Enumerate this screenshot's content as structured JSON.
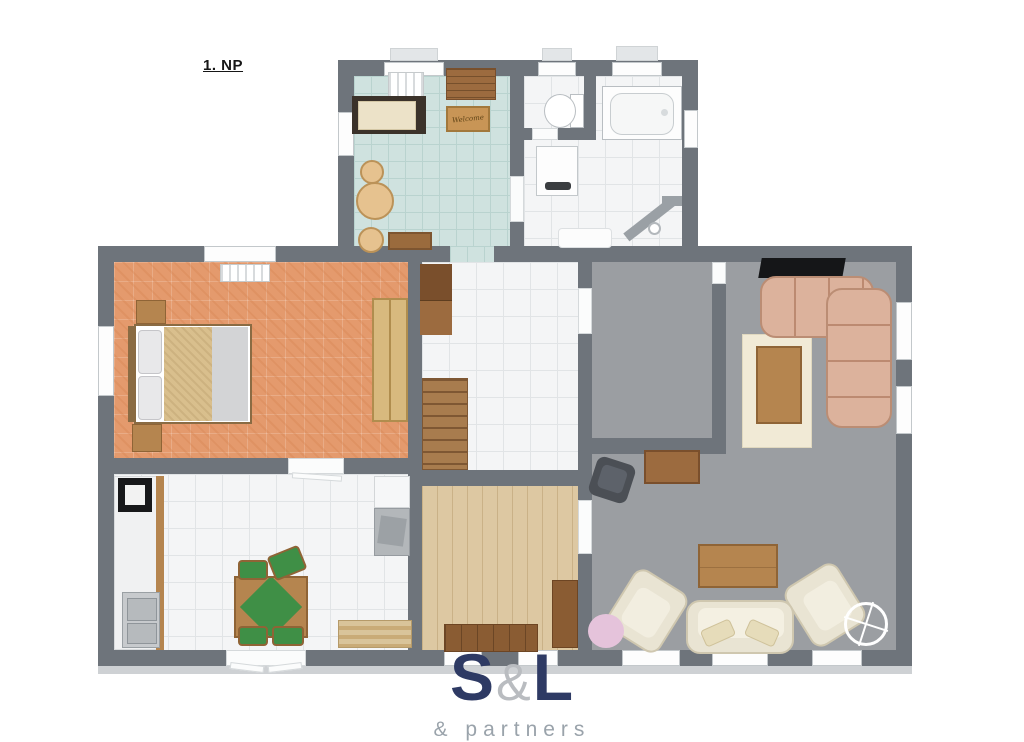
{
  "floor_label": "1. NP",
  "entry": {
    "welcome_mat": "Welcome"
  },
  "logo": {
    "part1": "S",
    "amp": "&",
    "part2": "L",
    "tagline": "& partners"
  },
  "colors": {
    "wall": "#6e747b",
    "wallOuter": "#ced1d4",
    "entryFloor": "#cfe2df",
    "entryGrout": "#b9d3cf",
    "tile": "#f4f5f6",
    "tileGrout": "#e1e4e6",
    "bedroomFloor": "#e49a6d",
    "grayFloor": "#9b9ea2",
    "woodFloor": "#ddc8a2",
    "stair": "#a87c4e",
    "stairLine": "#7e5733",
    "wood": "#b5854f",
    "woodDark": "#8f6436",
    "cabinetBrown": "#9c6b3f",
    "cabinetDark": "#7a4f2c",
    "sofaTan": "#dcb29c",
    "sofaTanLine": "#bb8d74",
    "cream": "#e9e4d3",
    "creamDark": "#cfc7af",
    "green": "#3f8f46",
    "pink": "#e5c3db",
    "navy": "#2e3a64",
    "logoAmp": "#b9bcc0",
    "tagline": "#9aa3ab"
  }
}
